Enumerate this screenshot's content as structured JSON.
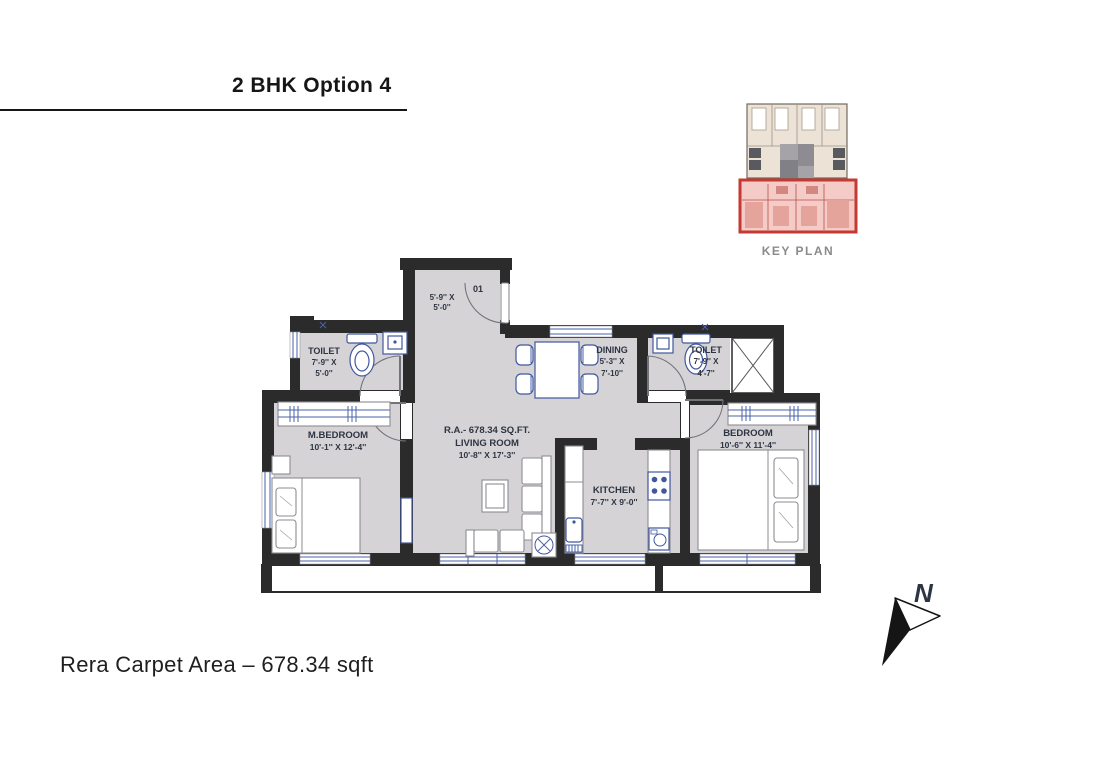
{
  "header": {
    "title": "2 BHK Option 4"
  },
  "key_plan": {
    "caption": "KEY PLAN"
  },
  "compass": {
    "north_label": "N"
  },
  "footer": {
    "carpet_area": "Rera Carpet Area – 678.34 sqft"
  },
  "colors": {
    "wall": "#2b2b2b",
    "floor": "#d5d3d6",
    "fixture_blue": "#41589f",
    "keyplan_highlight_border": "#c43a33",
    "keyplan_highlight_fill": "#f5cbc7",
    "keyplan_building_fill": "#ece3d6",
    "label_text": "#2d3442"
  },
  "floor_plan": {
    "foyer": {
      "dim_line1": "5'-9'' X",
      "dim_line2": "5'-0''",
      "door_number": "01"
    },
    "toilet_left": {
      "name": "TOILET",
      "dim_line1": "7'-9'' X",
      "dim_line2": "5'-0''"
    },
    "dining": {
      "name": "DINING",
      "dim_line1": "5'-3'' X",
      "dim_line2": "7'-10''"
    },
    "toilet_right": {
      "name": "TOILET",
      "dim_line1": "7'-9'' X",
      "dim_line2": "4'-7''"
    },
    "master_bedroom": {
      "name": "M.BEDROOM",
      "dim": "10'-1'' X 12'-4''"
    },
    "living_room": {
      "area": "R.A.- 678.34 SQ.FT.",
      "name": "LIVING ROOM",
      "dim": "10'-8'' X 17'-3''"
    },
    "kitchen": {
      "name": "KITCHEN",
      "dim": "7'-7'' X 9'-0''"
    },
    "bedroom": {
      "name": "BEDROOM",
      "dim": "10'-6'' X 11'-4''"
    }
  }
}
